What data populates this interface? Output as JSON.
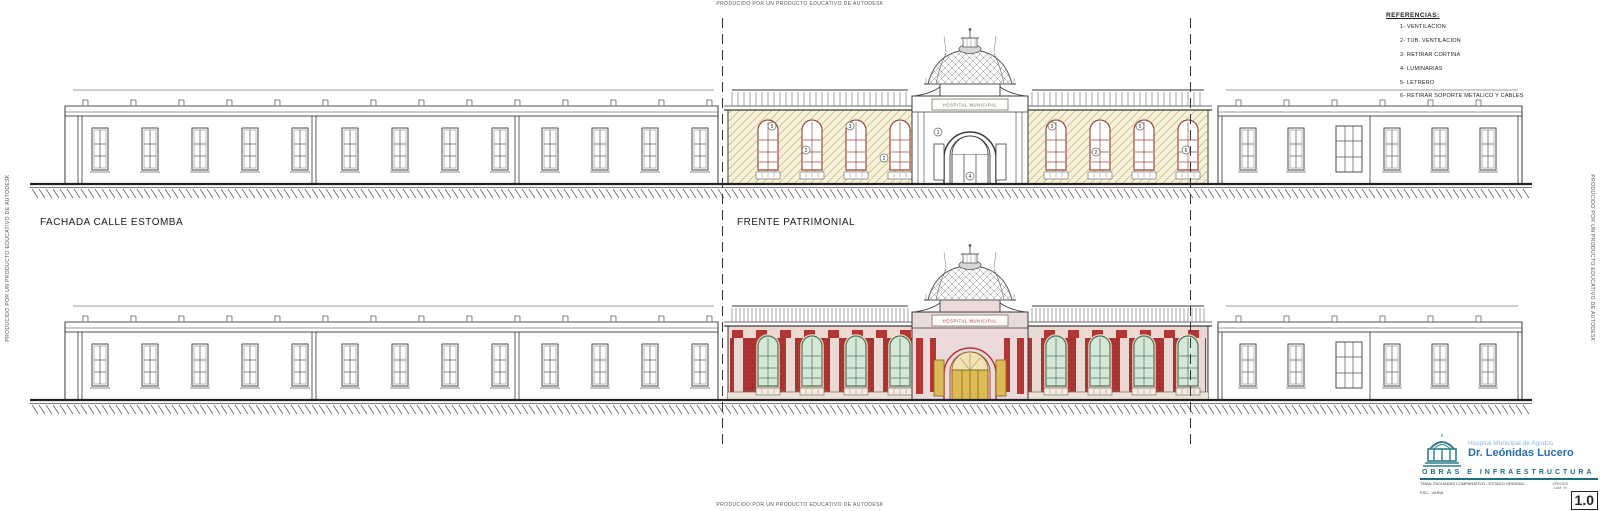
{
  "watermark": {
    "text": "PRODUCIDO POR UN PRODUCTO EDUCATIVO DE AUTODESK"
  },
  "labels": {
    "left_elevation": "FACHADA CALLE ESTOMBA",
    "center_elevation": "FRENTE PATRIMONIAL"
  },
  "legend": {
    "title": "REFERENCIAS:",
    "items": [
      "1- VENTILACION",
      "2- TUB. VENTILACION",
      "3- RETIRAR CORTINA",
      "4- LUMINARIAS",
      "5- LETRERO",
      "6- RETIRAR SOPORTE METALICO Y CABLES"
    ]
  },
  "sign": {
    "text": "HOSPITAL MUNICIPAL"
  },
  "annotations": [
    {
      "x": 772,
      "y": 100,
      "label": "5"
    },
    {
      "x": 806,
      "y": 124,
      "label": "2"
    },
    {
      "x": 850,
      "y": 100,
      "label": "3"
    },
    {
      "x": 884,
      "y": 132,
      "label": "2"
    },
    {
      "x": 938,
      "y": 106,
      "label": "1"
    },
    {
      "x": 970,
      "y": 150,
      "label": "4"
    },
    {
      "x": 1052,
      "y": 100,
      "label": "3"
    },
    {
      "x": 1096,
      "y": 126,
      "label": "2"
    },
    {
      "x": 1140,
      "y": 100,
      "label": "5"
    },
    {
      "x": 1186,
      "y": 124,
      "label": "6"
    }
  ],
  "title_block": {
    "hospital_line1": "Hospital Municipal de Agudos",
    "hospital_line2": "Dr. Leónidas Lucero",
    "department": "OBRAS E INFRAESTRUCTURA",
    "subject": "TEMA: FACHADAS COMPARATIVO - ESTADO ORIGINAL",
    "scale": "ESC.: VARIA",
    "version_label": "VERSION",
    "sheet_label": "LAM. N°:",
    "version": "1.0",
    "fields": {
      "drawn": "DIBUJO:",
      "date": "FECHA:",
      "dept": "DEPTO. PROYECTOS Y OBRAS",
      "municipality": "MUNICIPALIDAD DE BAHIA BLANCA"
    }
  },
  "colors": {
    "paper": "#ffffff",
    "ink": "#3a3a3a",
    "existing_wall": "#f7f2da",
    "existing_hatch": "#c4b077",
    "existing_window_frame": "#9a4a42",
    "brick": "#b53434",
    "brick_joint": "#8e2626",
    "pilaster_pink": "#e9d9d3",
    "base_band": "#eee2d6",
    "glass_green": "#d5e9d9",
    "window_mullion": "#4f6f5c",
    "window_trim_cream": "#ece0c2",
    "door_gold": "#dcbb54",
    "door_gold_dark": "#8a6a20",
    "entrance_pink": "#eadada",
    "dome_cap_gray": "#d8d8d8",
    "title_teal": "#1c6e7e",
    "title_blue": "#2b6cb0",
    "title_lightblue": "#8ab8d8"
  }
}
